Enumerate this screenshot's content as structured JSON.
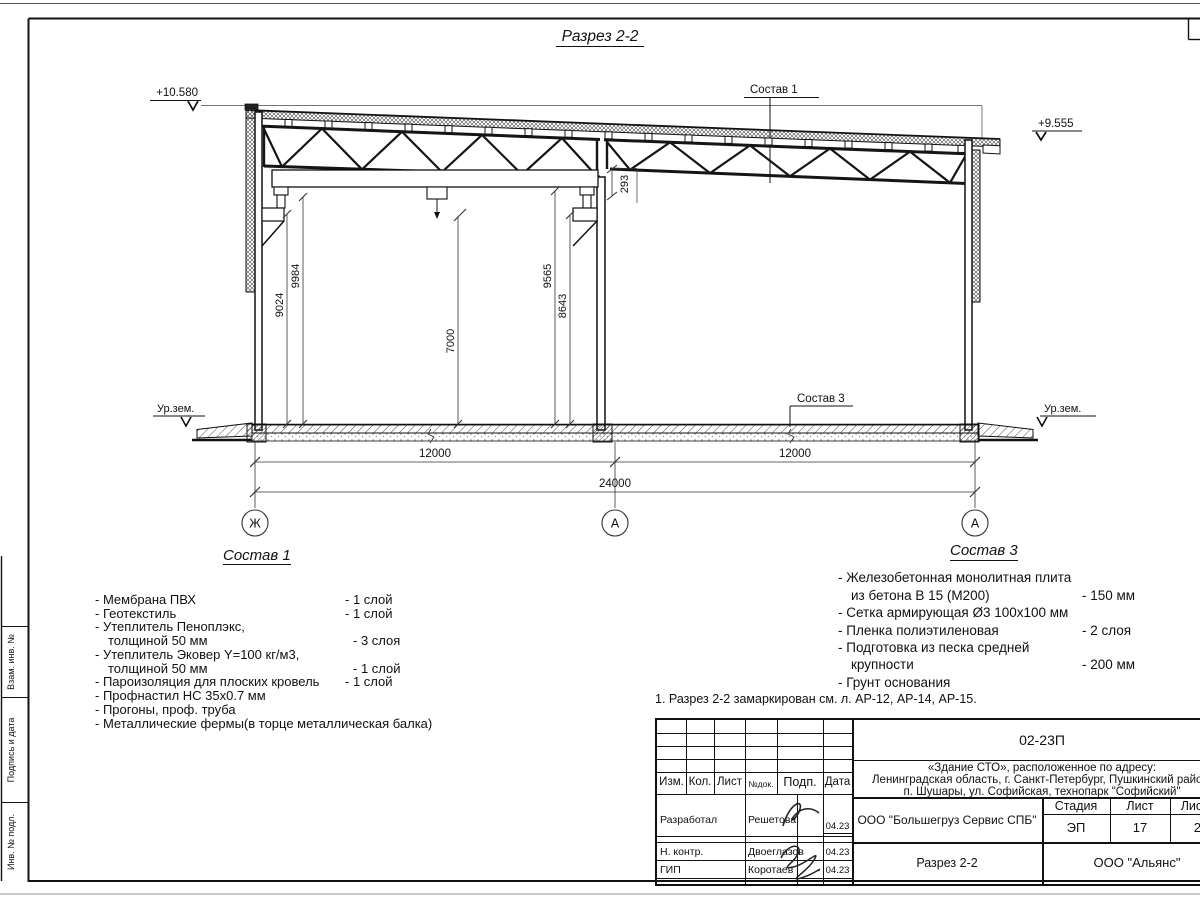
{
  "drawing": {
    "title": "Разрез 2-2",
    "elevation_left": "+10.580",
    "elevation_right": "+9.555",
    "ground_left": "Ур.зем.",
    "ground_right": "Ур.зем.",
    "leader1": "Состав 1",
    "leader3": "Состав 3",
    "dims": {
      "v1": "9024",
      "v2": "9984",
      "v3": "7000",
      "v4": "9565",
      "v5": "8643",
      "gap": "293",
      "bay1": "12000",
      "bay2": "12000",
      "total": "24000"
    },
    "axes": [
      "Ж",
      "А",
      "А"
    ]
  },
  "sostav1": {
    "heading": "Состав 1",
    "items": [
      {
        "name": "- Мембрана ПВХ",
        "qty": "- 1 слой"
      },
      {
        "name": "- Геотекстиль",
        "qty": "- 1 слой"
      },
      {
        "name": "- Утеплитель Пеноплэкс,",
        "qty": ""
      },
      {
        "name": "толщиной 50 мм",
        "qty": "- 3 слоя"
      },
      {
        "name": "- Утеплитель Эковер Y=100 кг/м3,",
        "qty": ""
      },
      {
        "name": "толщиной 50 мм",
        "qty": "- 1 слой"
      },
      {
        "name": "- Пароизоляция для плоских кровель",
        "qty": "- 1 слой"
      },
      {
        "name": "- Профнастил НС 35х0.7 мм",
        "qty": ""
      },
      {
        "name": "- Прогоны, проф. труба",
        "qty": ""
      },
      {
        "name": "- Металлические фермы(в торце металлическая балка)",
        "qty": ""
      }
    ]
  },
  "sostav3": {
    "heading": "Состав 3",
    "items": [
      {
        "name": "- Железобетонная  монолитная плита",
        "qty": ""
      },
      {
        "name": "из бетона В 15 (М200)",
        "qty": "- 150 мм"
      },
      {
        "name": "- Сетка армирующая Ø3 100х100 мм",
        "qty": ""
      },
      {
        "name": "- Пленка полиэтиленовая",
        "qty": "-  2 слоя"
      },
      {
        "name": "- Подготовка из песка средней",
        "qty": ""
      },
      {
        "name": "крупности",
        "qty": "- 200 мм"
      },
      {
        "name": "- Грунт основания",
        "qty": ""
      }
    ]
  },
  "note": "1. Разрез 2-2 замаркирован см. л. АР-12, АР-14, АР-15.",
  "titleblock": {
    "code": "02-23П",
    "object": [
      "«Здание СТО», расположенное по адресу:",
      "Ленинградская область, г. Санкт-Петербург, Пушкинский район,",
      "п. Шушары, ул. Софийская, технопарк \"Софийский\""
    ],
    "cols": [
      "Изм.",
      "Кол.",
      "Лист",
      "№док.",
      "Подп.",
      "Дата"
    ],
    "rows": [
      {
        "role": "Разработал",
        "name": "Решетова",
        "date": "04.23"
      },
      {
        "role": "Н. контр.",
        "name": "Двоеглазов",
        "date": "04.23"
      },
      {
        "role": "ГИП",
        "name": "Коротаев",
        "date": "04.23"
      }
    ],
    "company": "ООО \"Большегруз Сервис СПБ\"",
    "stage_label": "Стадия",
    "sheet_label": "Лист",
    "sheets_label": "Листов",
    "stage": "ЭП",
    "sheet": "17",
    "sheets": "21",
    "doc_name": "Разрез 2-2",
    "org": "ООО \"Альянс\""
  },
  "frame": {
    "side_labels": [
      "Взам. инв. №",
      "Подпись и дата",
      "Инв. № подл."
    ]
  }
}
